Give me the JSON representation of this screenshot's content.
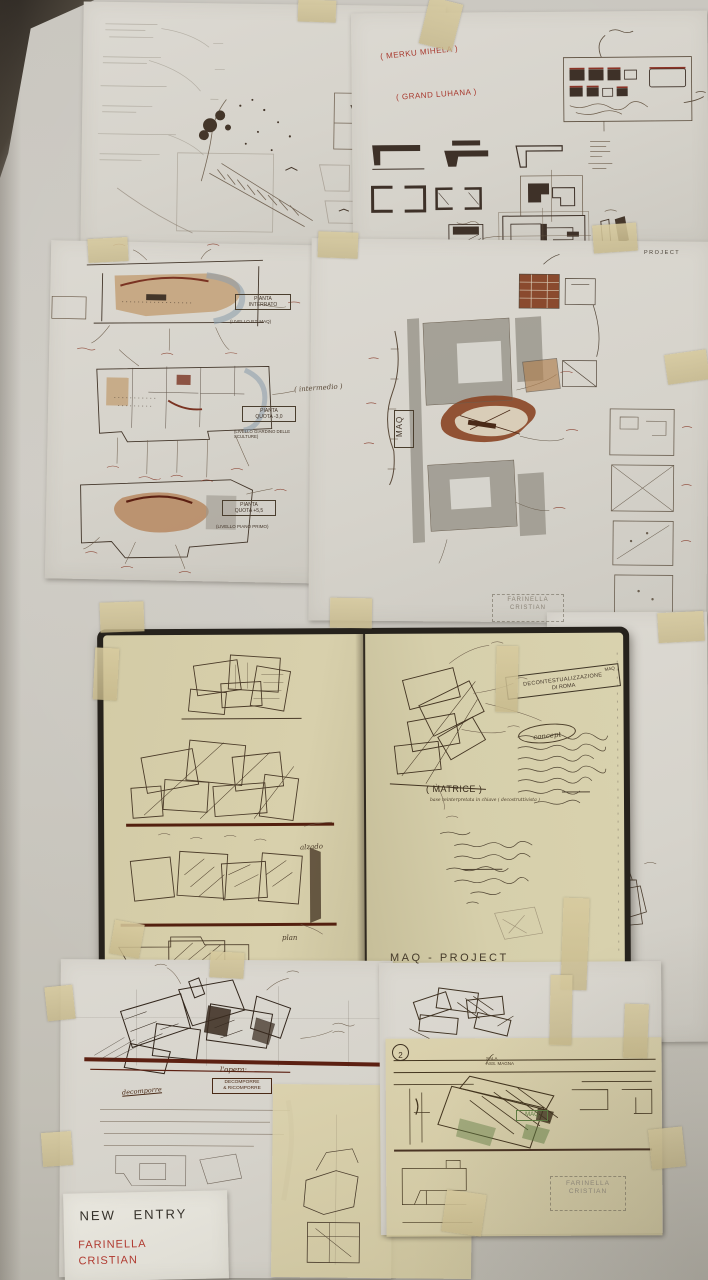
{
  "scene": {
    "title": "Architecture concept wall - MAQ project sketches",
    "wall_color": "#c8c5bd",
    "paper_color": "#d8d5cd",
    "notebook_page_color": "#d6cfab",
    "tape_color": "#d2c49a",
    "red_ink": "#a8392e",
    "sepia_ink": "#43362a",
    "dark_red_ink": "#5c2012",
    "green_ink": "#5f7d42"
  },
  "top_right_sheet": {
    "red_note_1": "( MERKU MIHELA )",
    "red_note_2": "( GRAND LUHANA )",
    "project_stamp": "PROJECT"
  },
  "plans_sheet": {
    "plan1": {
      "title_l1": "PIANTA",
      "title_l2": "INTERRATO",
      "level": "(LIVELLO P.T. MAQ)"
    },
    "plan2": {
      "note": "( intermedio )",
      "title_l1": "PIANTA",
      "title_l2": "QUOTA -3,0",
      "level": "(LIVELLO GIARDINO DELLE SCULTURE)"
    },
    "plan3": {
      "title_l1": "PIANTA",
      "title_l2": "QUOTA +5,5",
      "level": "(LIVELLO PIANO PRIMO)"
    }
  },
  "site_sheet": {
    "maq_label": "MAQ",
    "signature_l1": "FARINELLA",
    "signature_l2": "CRISTIAN"
  },
  "notebook": {
    "concept_box_l1": "MAQ",
    "concept_box_l2": "DECONTESTUALIZZAZIONE",
    "concept_box_l3": "DI ROMA",
    "concept_circle": "concept",
    "matrice": "( MATRICE )",
    "matrice_sub": "base reinterpretata in chiave ( decostruttivista )",
    "alzado": "alzado",
    "plan_label": "plan",
    "footer": "MAQ - PROJECT"
  },
  "perspective_sheet": {
    "opera": "l'opera:",
    "box_l1": "DECOMPORRE",
    "box_l2": "& RICOMPORRE",
    "note": "decomporre"
  },
  "bottom_right_sheet": {
    "number": "2",
    "sala_l1": "SALA",
    "sala_l2": "ASS. MAGNA",
    "maq_green": "MAQ",
    "stamp_l1": "FARINELLA",
    "stamp_l2": "CRISTIAN"
  },
  "entry_card": {
    "line1": "NEW ENTRY",
    "line2": "FARINELLA",
    "line3": "CRISTIAN"
  }
}
